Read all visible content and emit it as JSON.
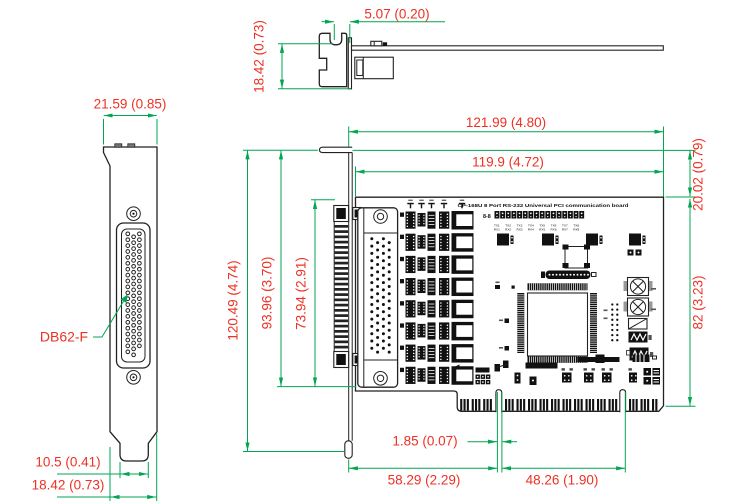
{
  "page": {
    "background": "#ffffff"
  },
  "colors": {
    "dimension_line": "#00a651",
    "dimension_text": "#ee3124",
    "drawing_line": "#222222"
  },
  "board": {
    "title": "CP-168U 8 Port RS-232 Universal PCI communication board",
    "jumper_block_label": "8-8",
    "port_labels_tx": [
      "TX1",
      "TX2",
      "TX3",
      "TX4",
      "TX5",
      "TX6",
      "TX7",
      "TX8"
    ],
    "port_labels_rx": [
      "RX1",
      "RX2",
      "RX3",
      "RX4",
      "RX5",
      "RX6",
      "RX7",
      "RX8"
    ]
  },
  "bracket": {
    "connector_label": "DB62-F"
  },
  "dimensions": {
    "top_view": {
      "offset": "5.07 (0.20)",
      "height": "18.42 (0.73)"
    },
    "bracket_view": {
      "top_width": "21.59 (0.85)",
      "foot_width": "10.5 (0.41)",
      "bottom_width": "18.42 (0.73)"
    },
    "board_view": {
      "total_width": "121.99 (4.80)",
      "pcb_width": "119.9 (4.72)",
      "top_offset": "20.02 (0.79)",
      "right_height": "82 (3.23)",
      "total_height": "120.49 (4.74)",
      "left_height": "93.96 (3.70)",
      "connector_height": "73.94 (2.91)",
      "key_notch_width": "1.85 (0.07)",
      "edge_left_segment": "58.29 (2.29)",
      "edge_right_segment": "48.26 (1.90)"
    }
  }
}
